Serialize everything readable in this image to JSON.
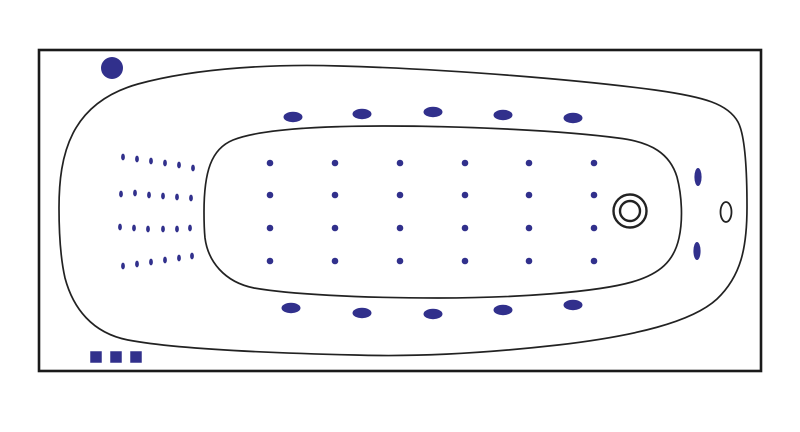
{
  "diagram": {
    "kind": "bathtub-top-view-jet-layout",
    "canvas": {
      "width": 800,
      "height": 432,
      "background": "#ffffff"
    },
    "colors": {
      "jet_fill": "#31308c",
      "outline_stroke": "#222222",
      "frame_stroke": "#1a1a1a"
    },
    "frame": {
      "x": 39,
      "y": 50,
      "width": 722,
      "height": 321,
      "stroke_width": 2.6
    },
    "tub_outline": {
      "stroke_width": 1.7,
      "path": "M 59,208 C 59,155 70,103 138,84 C 200,67 280,64 340,66 C 450,69 580,80 655,90 C 705,97 728,104 738,122 C 745,135 747,168 747,207 C 747,248 741,276 717,299 C 692,322 635,336 558,345 C 487,353 415,357 355,355 C 270,353 175,349 128,340 C 92,333 73,308 65,278 C 60,256 59,230 59,208 Z"
    },
    "basin_outline": {
      "stroke_width": 1.7,
      "path": "M 204,212 C 204,172 211,149 233,140 C 258,130 315,126 385,126 C 470,126 565,131 618,138 C 652,142 670,154 677,177 C 682,196 683,220 679,238 C 674,261 660,274 632,282 C 597,292 518,298 438,298 C 358,298 288,294 254,288 C 224,282 208,261 205,238 C 204,228 204,220 204,212 Z"
    },
    "pump_jet": {
      "cx": 112,
      "cy": 68,
      "r": 11
    },
    "deck_jets": {
      "rx": 9.5,
      "ry": 5.2,
      "top": [
        [
          293,
          117
        ],
        [
          362,
          114
        ],
        [
          433,
          112
        ],
        [
          503,
          115
        ],
        [
          573,
          118
        ]
      ],
      "bottom": [
        [
          291,
          308
        ],
        [
          362,
          313
        ],
        [
          433,
          314
        ],
        [
          503,
          310
        ],
        [
          573,
          305
        ]
      ]
    },
    "side_jets": {
      "rx": 3.6,
      "ry": 9,
      "points": [
        [
          698,
          177
        ],
        [
          697,
          251
        ]
      ]
    },
    "drain": {
      "cx": 630,
      "cy": 211,
      "outer_r": 16.5,
      "inner_r": 10,
      "stroke_width": 2.4
    },
    "overflow_hole": {
      "cx": 726,
      "cy": 212,
      "rx": 5.5,
      "ry": 10,
      "stroke_width": 1.8
    },
    "floor_jets": {
      "r": 3.3,
      "columns": [
        270,
        335,
        400,
        465,
        529,
        594
      ],
      "rows": [
        163,
        195,
        228,
        261
      ]
    },
    "micro_air_jets": {
      "rx": 1.9,
      "ry": 3.4,
      "rows": [
        [
          [
            123,
            157
          ],
          [
            137,
            159
          ],
          [
            151,
            161
          ],
          [
            165,
            163
          ],
          [
            179,
            165
          ],
          [
            193,
            168
          ]
        ],
        [
          [
            121,
            194
          ],
          [
            135,
            193
          ],
          [
            149,
            195
          ],
          [
            163,
            196
          ],
          [
            177,
            197
          ],
          [
            191,
            198
          ]
        ],
        [
          [
            120,
            227
          ],
          [
            134,
            228
          ],
          [
            148,
            229
          ],
          [
            163,
            229
          ],
          [
            177,
            229
          ],
          [
            190,
            228
          ]
        ],
        [
          [
            123,
            266
          ],
          [
            137,
            264
          ],
          [
            151,
            262
          ],
          [
            165,
            260
          ],
          [
            179,
            258
          ],
          [
            192,
            256
          ]
        ]
      ]
    },
    "control_squares": {
      "size": 11.5,
      "centers": [
        [
          96,
          357
        ],
        [
          116,
          357
        ],
        [
          136,
          357
        ]
      ]
    }
  }
}
